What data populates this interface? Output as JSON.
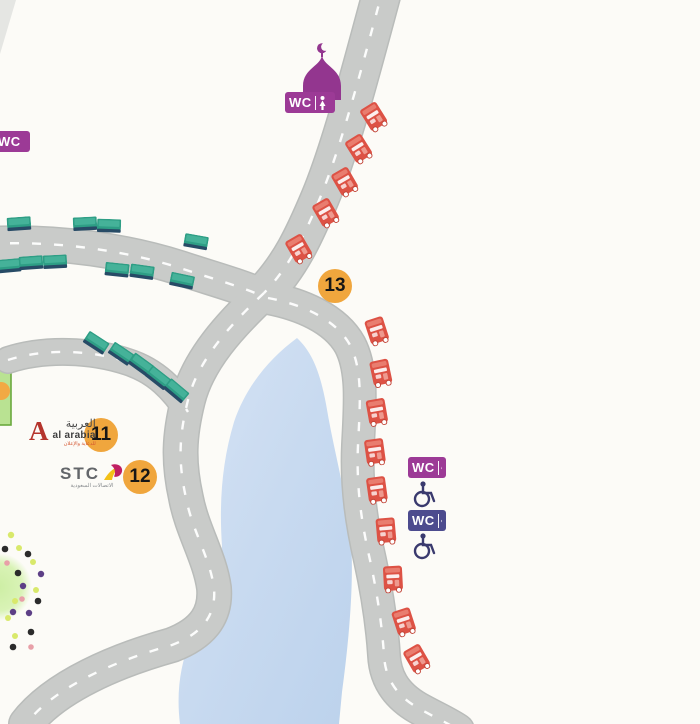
{
  "map": {
    "title": "Event site map with roads, lake, food trucks and facilities",
    "wc_label": "WC",
    "wc_badges": [
      {
        "label": "WC",
        "variant": "women",
        "position": "top-left-edge"
      },
      {
        "label": "WC",
        "variant": "women",
        "position": "below-mosque"
      },
      {
        "label": "WC",
        "variant": "women",
        "position": "right-upper"
      },
      {
        "label": "WC",
        "variant": "men",
        "position": "right-lower"
      }
    ],
    "markers": {
      "m11": "11",
      "m12": "12",
      "m13": "13"
    },
    "logos": {
      "al_arabia": {
        "initial": "A",
        "arabic": "العربية",
        "latin": "al arabia",
        "tagline": "للدعاية والإعلان"
      },
      "stc": {
        "latin": "STC",
        "arabic": "الاتصالات السعودية"
      }
    },
    "counts": {
      "food_trucks": 14,
      "parking_stalls": 15,
      "wheelchair_icons": 2
    },
    "colors": {
      "background": "#fcfbf7",
      "road": "#c9cbc9",
      "road_edge": "#babdbb",
      "lake": "#cbdcf0",
      "stall_teal": "#2e9e85",
      "truck_red": "#dd5245",
      "badge_women_purple": "#9c3a96",
      "badge_men_indigo": "#4c4b8e",
      "marker_orange": "#f0a63d",
      "mosque_purple": "#93368f",
      "wheelchair_navy": "#3a3a6e",
      "dot_black": "#2b2b2b",
      "dot_purple": "#5d3f86",
      "dot_yellowgreen": "#d9e96b",
      "dot_pink": "#e8a0a8",
      "stage_green": "#b9e292"
    },
    "icons": [
      "mosque-icon",
      "crescent-icon",
      "wc-badge",
      "restroom-person-icon",
      "wheelchair-icon",
      "food-truck-icon",
      "parking-stall-icon",
      "lake-shape",
      "road-path",
      "confetti-dot",
      "stage-strip",
      "green-blob"
    ]
  }
}
